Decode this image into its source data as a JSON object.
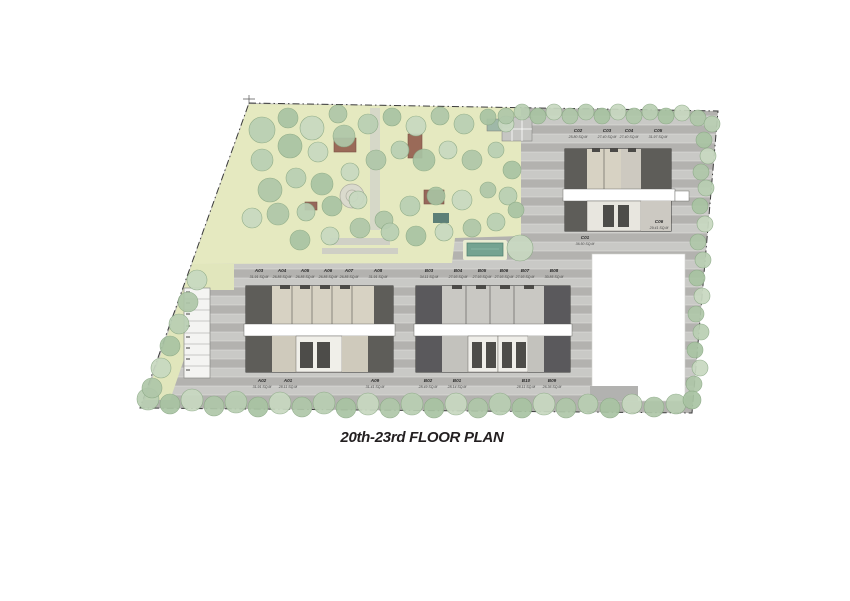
{
  "title": "20th-23rd FLOOR PLAN",
  "units": {
    "a_top": [
      {
        "id": "A03",
        "area": "31.91 SQ.M"
      },
      {
        "id": "A04",
        "area": "26.85 SQ.M"
      },
      {
        "id": "A05",
        "area": "26.85 SQ.M"
      },
      {
        "id": "A06",
        "area": "26.85 SQ.M"
      },
      {
        "id": "A07",
        "area": "26.85 SQ.M"
      },
      {
        "id": "A08",
        "area": "31.91 SQ.M"
      }
    ],
    "a_bottom": [
      {
        "id": "A02",
        "area": "31.91 SQ.M"
      },
      {
        "id": "A01",
        "area": "28.11 SQ.M"
      },
      {
        "id": "A09",
        "area": "31.41 SQ.M"
      }
    ],
    "b_top": [
      {
        "id": "B03",
        "area": "34.11 SQ.M"
      },
      {
        "id": "B04",
        "area": "27.93 SQ.M"
      },
      {
        "id": "B05",
        "area": "27.93 SQ.M"
      },
      {
        "id": "B06",
        "area": "27.93 SQ.M"
      },
      {
        "id": "B07",
        "area": "27.93 SQ.M"
      },
      {
        "id": "B08",
        "area": "30.85 SQ.M"
      }
    ],
    "b_bottom": [
      {
        "id": "B02",
        "area": "28.49 SQ.M"
      },
      {
        "id": "B01",
        "area": "28.14 SQ.M"
      },
      {
        "id": "B10",
        "area": "28.11 SQ.M"
      },
      {
        "id": "B09",
        "area": "26.36 SQ.M"
      }
    ],
    "c_top": [
      {
        "id": "C02",
        "area": "25.80 SQ.M"
      },
      {
        "id": "C03",
        "area": "27.40 SQ.M"
      },
      {
        "id": "C04",
        "area": "27.40 SQ.M"
      },
      {
        "id": "C05",
        "area": "31.97 SQ.M"
      }
    ],
    "c_bottom": [
      {
        "id": "C01",
        "area": "36.50 SQ.M"
      },
      {
        "id": "C06",
        "area": "29.41 SQ.M"
      }
    ]
  },
  "colors": {
    "road": "#b3b2af",
    "road_stripe": "#c9c9c6",
    "lawn": "#e5e9c0",
    "tree_canopy": "#b9cfb3",
    "building_dark": "#5e5d59",
    "building_beige": "#d7d2c3",
    "building_light": "#c9c6bf",
    "corridor": "#ffffff",
    "pool": "#74a391",
    "pavilion": "#9a6a58",
    "boundary": "#3c3c3c",
    "title_text": "#231f20"
  }
}
